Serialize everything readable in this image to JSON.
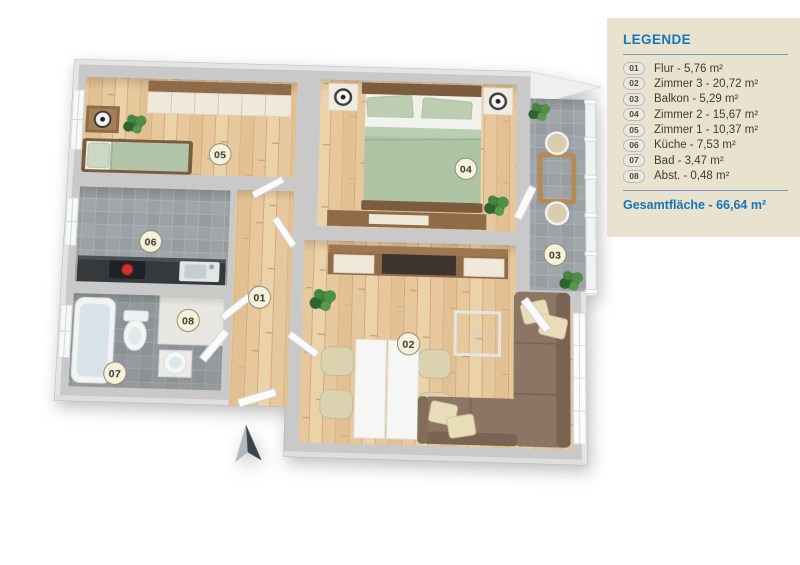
{
  "legend": {
    "title": "LEGENDE",
    "items": [
      {
        "num": "01",
        "text": "Flur - 5,76 m²"
      },
      {
        "num": "02",
        "text": "Zimmer 3 - 20,72 m²"
      },
      {
        "num": "03",
        "text": "Balkon - 5,29 m²"
      },
      {
        "num": "04",
        "text": "Zimmer 2 - 15,67 m²"
      },
      {
        "num": "05",
        "text": "Zimmer 1 - 10,37 m²"
      },
      {
        "num": "06",
        "text": "Küche - 7,53 m²"
      },
      {
        "num": "07",
        "text": "Bad - 3,47 m²"
      },
      {
        "num": "08",
        "text": "Abst. - 0,48 m²"
      }
    ],
    "total": "Gesamtfläche - 66,64 m²",
    "accent_color": "#1577b5",
    "panel_bg": "#e9e2cf"
  },
  "plan": {
    "rooms": [
      {
        "num": "01",
        "name": "Flur"
      },
      {
        "num": "02",
        "name": "Zimmer 3"
      },
      {
        "num": "03",
        "name": "Balkon"
      },
      {
        "num": "04",
        "name": "Zimmer 2"
      },
      {
        "num": "05",
        "name": "Zimmer 1"
      },
      {
        "num": "06",
        "name": "Küche"
      },
      {
        "num": "07",
        "name": "Bad"
      },
      {
        "num": "08",
        "name": "Abstellraum"
      }
    ],
    "badge_bg": "#f6f1da",
    "wall_color": "#c9c9c9",
    "wood_color": "#e6c89c",
    "tile_color": "#9ba1a4"
  }
}
